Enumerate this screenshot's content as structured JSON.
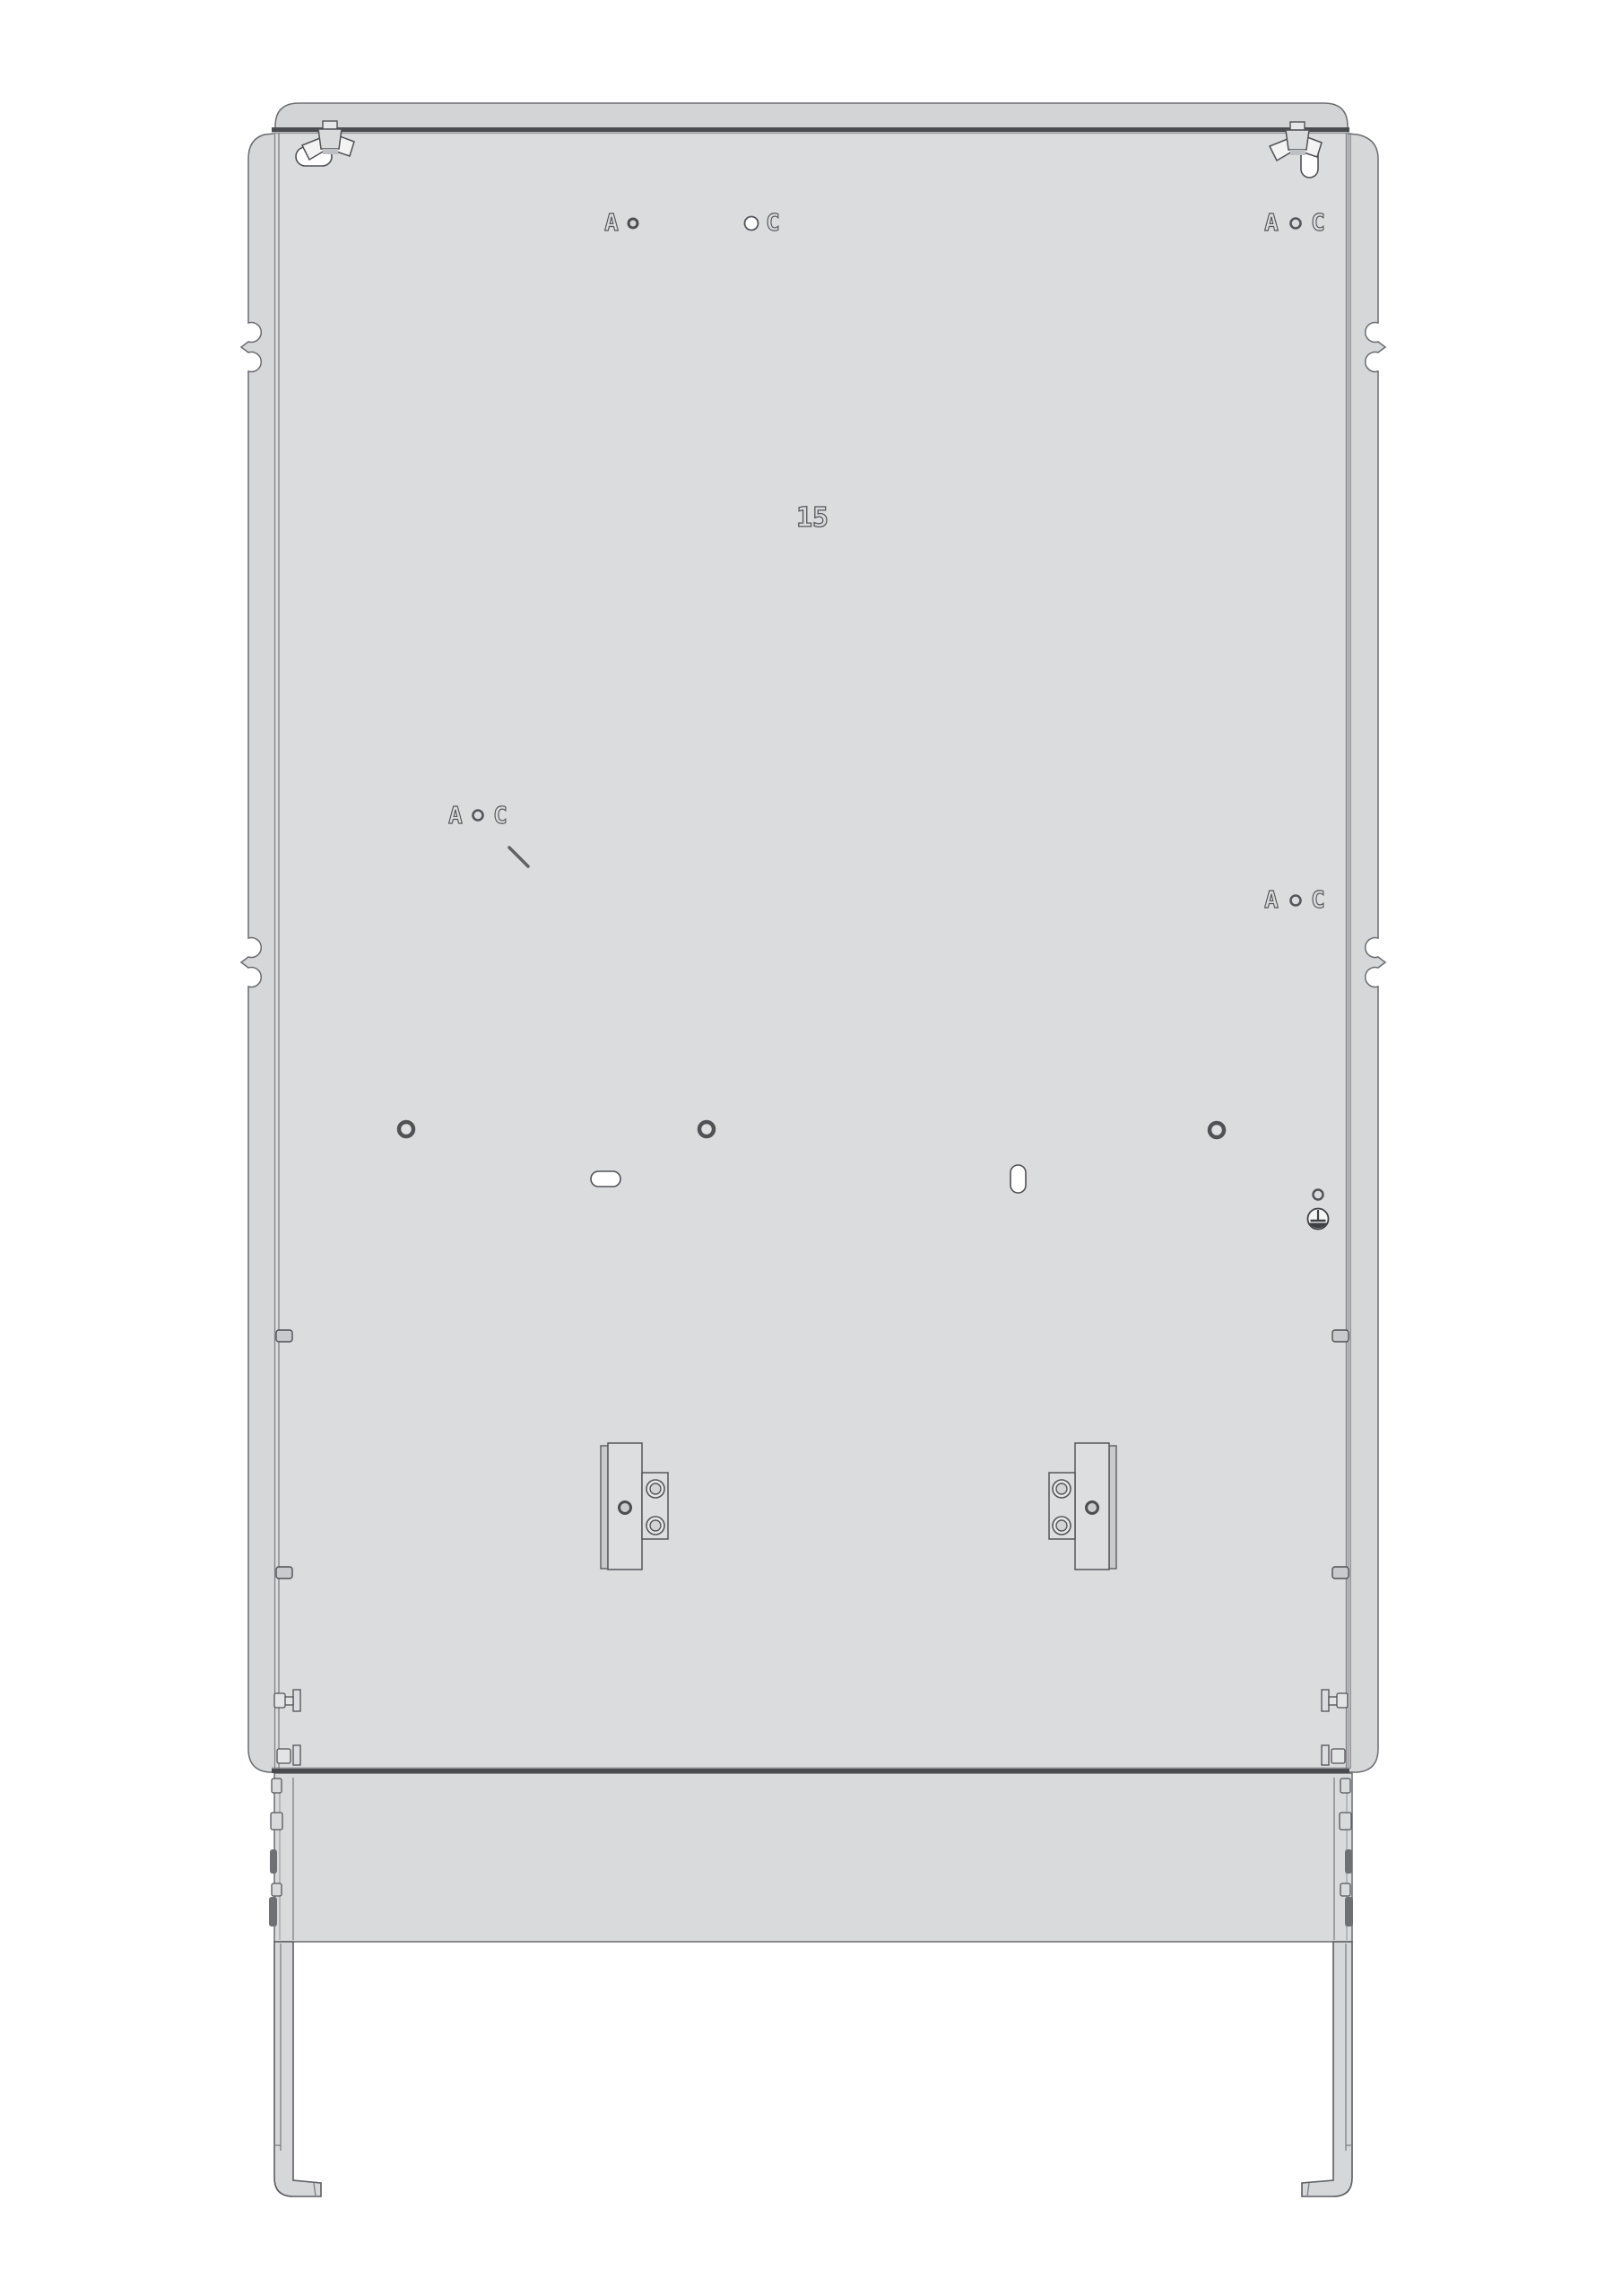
{
  "drawing": {
    "markings": {
      "letter_a": "A",
      "letter_c": "C",
      "panel_number": "15"
    },
    "colors": {
      "background": "#ffffff",
      "rear_panel": "#dbdcde",
      "top_strip": "#d3d4d6",
      "side_flange": "#d6d7d9",
      "base_panel": "#d9dadc",
      "edge_dark": "#4a4b4f",
      "outline": "#6b6c70",
      "engraving": "#55565b",
      "hole_fill": "#ffffff",
      "dark_fitting": "#6f7074"
    },
    "icons": {
      "wing_nut": "wing-nut-icon",
      "keyhole_slot": "keyhole-slot",
      "mounting_hole": "mounting-hole",
      "cable_slot": "cable-slot",
      "ground_terminal": "ground-terminal-icon",
      "latch_bolt": "latch-bolt-icon",
      "din_bracket": "din-bracket",
      "leg": "cabinet-leg"
    }
  }
}
